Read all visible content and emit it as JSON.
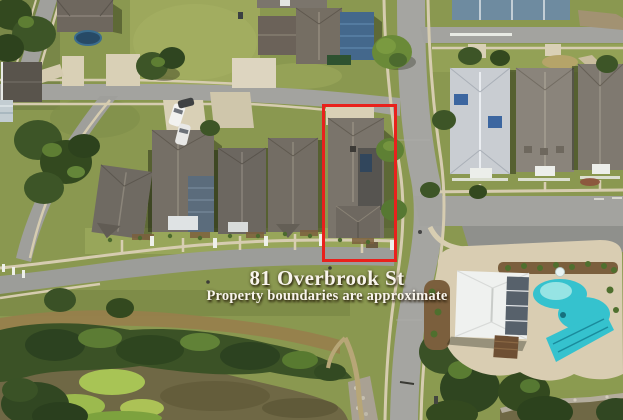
{
  "overlay": {
    "address": "81 Overbrook St",
    "disclaimer": "Property boundaries are approximate"
  },
  "boundary": {
    "x": 322,
    "y": 104,
    "width": 75,
    "height": 158
  },
  "colors": {
    "boundary_red": "#e9211c",
    "text_color": "#f8f4ec",
    "grass": "#8a9850",
    "street_gray": "#a3a39f",
    "concrete_tan": "#d6ccb0",
    "roof_gray": "#716c64",
    "roof_blue": "#44688c",
    "pond_olive": "#6f6845",
    "algae_green": "#a8c455",
    "pool_turquoise": "#35c2ce",
    "tree_green": "#3c5426",
    "deck_tan": "#d9cdb2"
  },
  "scene": {
    "type": "aerial-drone-photo",
    "features": [
      "residential streets",
      "single-family homes",
      "highlighted property",
      "pond with algae",
      "community pool",
      "clubhouse",
      "parking spaces",
      "parked cars",
      "trees"
    ]
  }
}
